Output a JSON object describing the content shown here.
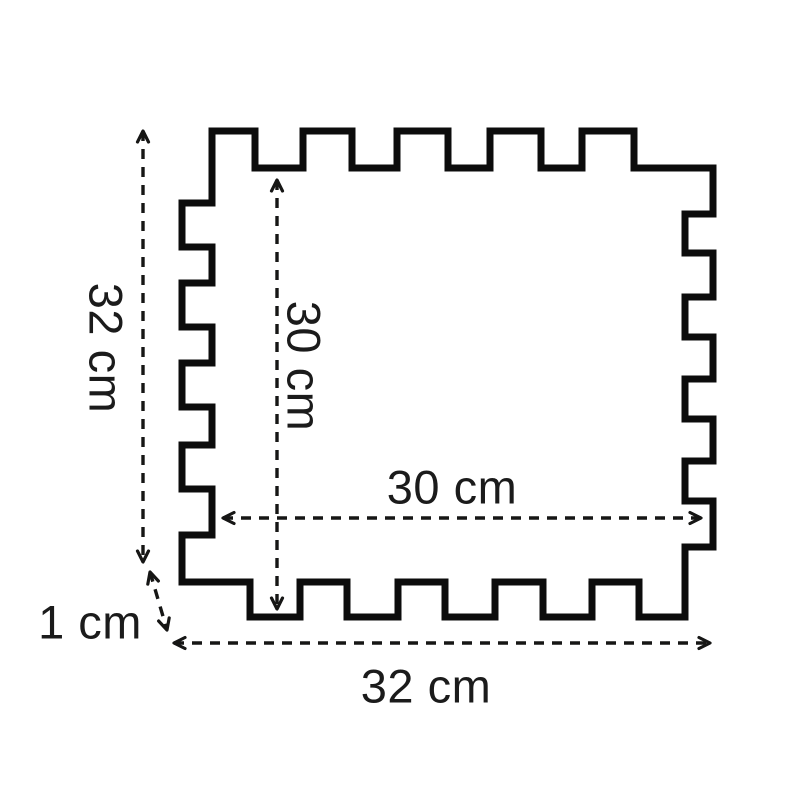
{
  "diagram": {
    "type": "technical-drawing",
    "subject": "interlocking-foam-tile-outline",
    "background_color": "#ffffff",
    "line_color": "#0c0c0c",
    "text_color": "#1b1b1b"
  },
  "dimensions": {
    "outer_height": {
      "label": "32 cm",
      "value": 32,
      "unit": "cm",
      "orientation": "vertical-left"
    },
    "inner_height": {
      "label": "30 cm",
      "value": 30,
      "unit": "cm",
      "orientation": "vertical-inner"
    },
    "inner_width": {
      "label": "30 cm",
      "value": 30,
      "unit": "cm",
      "orientation": "horizontal-inner"
    },
    "outer_width": {
      "label": "32 cm",
      "value": 32,
      "unit": "cm",
      "orientation": "horizontal-bottom"
    },
    "tab_depth": {
      "label": "1 cm",
      "value": 1,
      "unit": "cm",
      "orientation": "diagonal-corner"
    }
  }
}
